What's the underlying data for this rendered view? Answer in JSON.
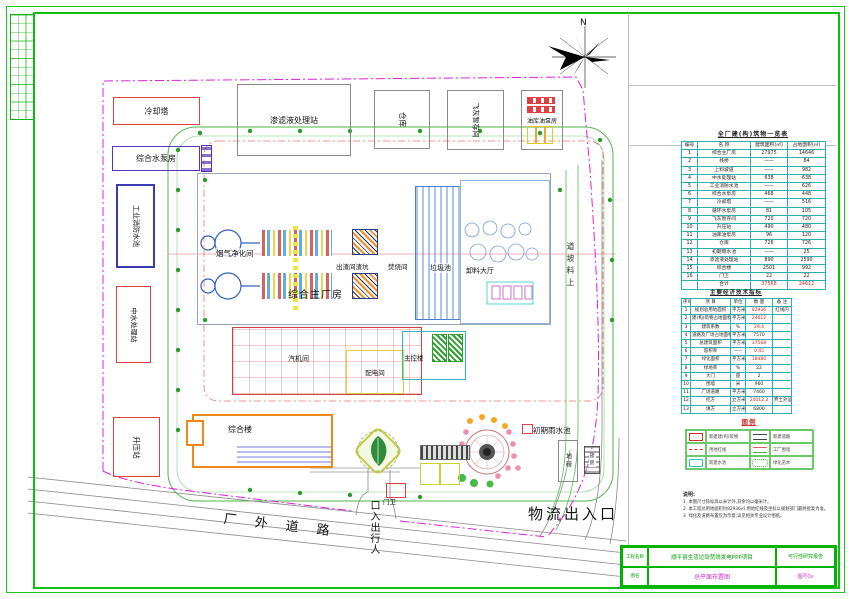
{
  "compass": {
    "north": "N"
  },
  "site": {
    "cooling_tower": "冷却塔",
    "water_pump_house": "综合水泵房",
    "leachate_station": "渗滤液处理站",
    "warehouse": "仓库",
    "fly_ash_room": "飞灰暂存间",
    "oil_pump_house": "油库油泵房",
    "fire_pool": "工业消防水池",
    "reclaimed_water_station": "中水处理站",
    "booster_station": "升压站",
    "flue_gas_room": "烟气净化间",
    "main_plant": "综合主厂房",
    "slag_room": "出渣间渣坑",
    "incinerator_room": "焚烧间",
    "waste_pit": "垃圾池",
    "unloading_hall": "卸料大厅",
    "turbine_room": "汽机间",
    "distribution_room": "配电间",
    "control_building": "主控楼",
    "office_building": "综合楼",
    "gate_house": "门卫",
    "rain_pool": "初期雨水池",
    "weighbridge": "地磅",
    "weigh_room": "磅房",
    "feed_ramp": "上料坡道",
    "outer_road": "厂 外 道 路",
    "logistics_gate": "物流出入口",
    "pedestrian_gate": "人行出入口"
  },
  "buildings_table": {
    "title": "全厂建(构)筑物一览表",
    "rows": [
      [
        "编号",
        "名 称",
        "建筑面积(㎡)",
        "占地面积(㎡)"
      ],
      [
        "1",
        "综合主厂房",
        "27975",
        "14646"
      ],
      [
        "2",
        "栈桥",
        "——",
        "84"
      ],
      [
        "3",
        "上料坡道",
        "——",
        "982"
      ],
      [
        "4",
        "中水处理站",
        "638",
        "638"
      ],
      [
        "5",
        "工业消防水池",
        "——",
        "626"
      ],
      [
        "6",
        "综合水泵房",
        "468",
        "448"
      ],
      [
        "7",
        "冷却塔",
        "——",
        "516"
      ],
      [
        "8",
        "循环水泵房",
        "81",
        "105"
      ],
      [
        "9",
        "飞灰暂存间",
        "720",
        "720"
      ],
      [
        "10",
        "升压站",
        "490",
        "480"
      ],
      [
        "11",
        "油库油泵房",
        "96",
        "120"
      ],
      [
        "12",
        "仓库",
        "726",
        "726"
      ],
      [
        "13",
        "初期雨水池",
        "——",
        "25"
      ],
      [
        "14",
        "渗滤液处理站",
        "890",
        "2590"
      ],
      [
        "15",
        "综合楼",
        "2501",
        "992"
      ],
      [
        "16",
        "门卫",
        "22",
        "22"
      ],
      [
        "",
        "合计",
        {
          "t": "37568",
          "c": "red"
        },
        {
          "t": "24612",
          "c": "red"
        }
      ]
    ]
  },
  "indicators_table": {
    "title": "主要经济技术指标",
    "rows": [
      [
        "序号",
        "项 目",
        "单位",
        "数 量",
        "备 注"
      ],
      [
        "1",
        "规划总用地面积",
        "平方米",
        {
          "t": "82936",
          "c": "red"
        },
        "红线内"
      ],
      [
        "2",
        "建(构)筑物占地面积",
        "平方米",
        {
          "t": "24612",
          "c": "red"
        },
        ""
      ],
      [
        "3",
        "建筑系数",
        "%",
        {
          "t": "29.4",
          "c": "red"
        },
        ""
      ],
      [
        "4",
        "道路及广场占地面积",
        "平方米",
        "7570",
        ""
      ],
      [
        "5",
        "总建筑面积",
        "平方米",
        {
          "t": "37568",
          "c": "red"
        },
        ""
      ],
      [
        "6",
        "容积率",
        "——",
        {
          "t": "0.45",
          "c": "red"
        },
        ""
      ],
      [
        "7",
        "绿化面积",
        "平方米",
        {
          "t": "18480",
          "c": "red"
        },
        ""
      ],
      [
        "8",
        "绿地率",
        "%",
        "22",
        ""
      ],
      [
        "9",
        "大门",
        "座",
        "2",
        ""
      ],
      [
        "10",
        "围墙",
        "米",
        "960",
        ""
      ],
      [
        "11",
        "广场道路",
        "平方米",
        "7460",
        ""
      ],
      [
        "12",
        "挖方",
        "立方米",
        {
          "t": "24012.3",
          "c": "red"
        },
        "弃土外运"
      ],
      [
        "13",
        "填方",
        "立方米",
        "6800",
        ""
      ]
    ]
  },
  "legend": {
    "title": "图例",
    "items": [
      {
        "label": "新建建(构)筑物"
      },
      {
        "label": "新建道路"
      },
      {
        "label": "用地红线"
      },
      {
        "label": "工厂围墙"
      },
      {
        "label": "新建水池"
      },
      {
        "label": "绿化苗木"
      }
    ]
  },
  "notes": {
    "heading": "说明:",
    "lines": [
      "1. 本图尺寸除标高以米计外,其余均以毫米计。",
      "2. 本工程总用地面积约82936㎡,用地红线及坐标以规划部门最终批复为准。",
      "3. 绿化及道路布置仅为示意,详见相关专业设计图纸。"
    ]
  },
  "title_block": {
    "project_label": "工程名称",
    "project_name": "顺平县生活垃圾焚烧发电PPP项目",
    "stage": "可行性研究报告",
    "drawing_label": "图名",
    "drawing_name": "总平面布置图",
    "drawing_no": "图号0x"
  }
}
